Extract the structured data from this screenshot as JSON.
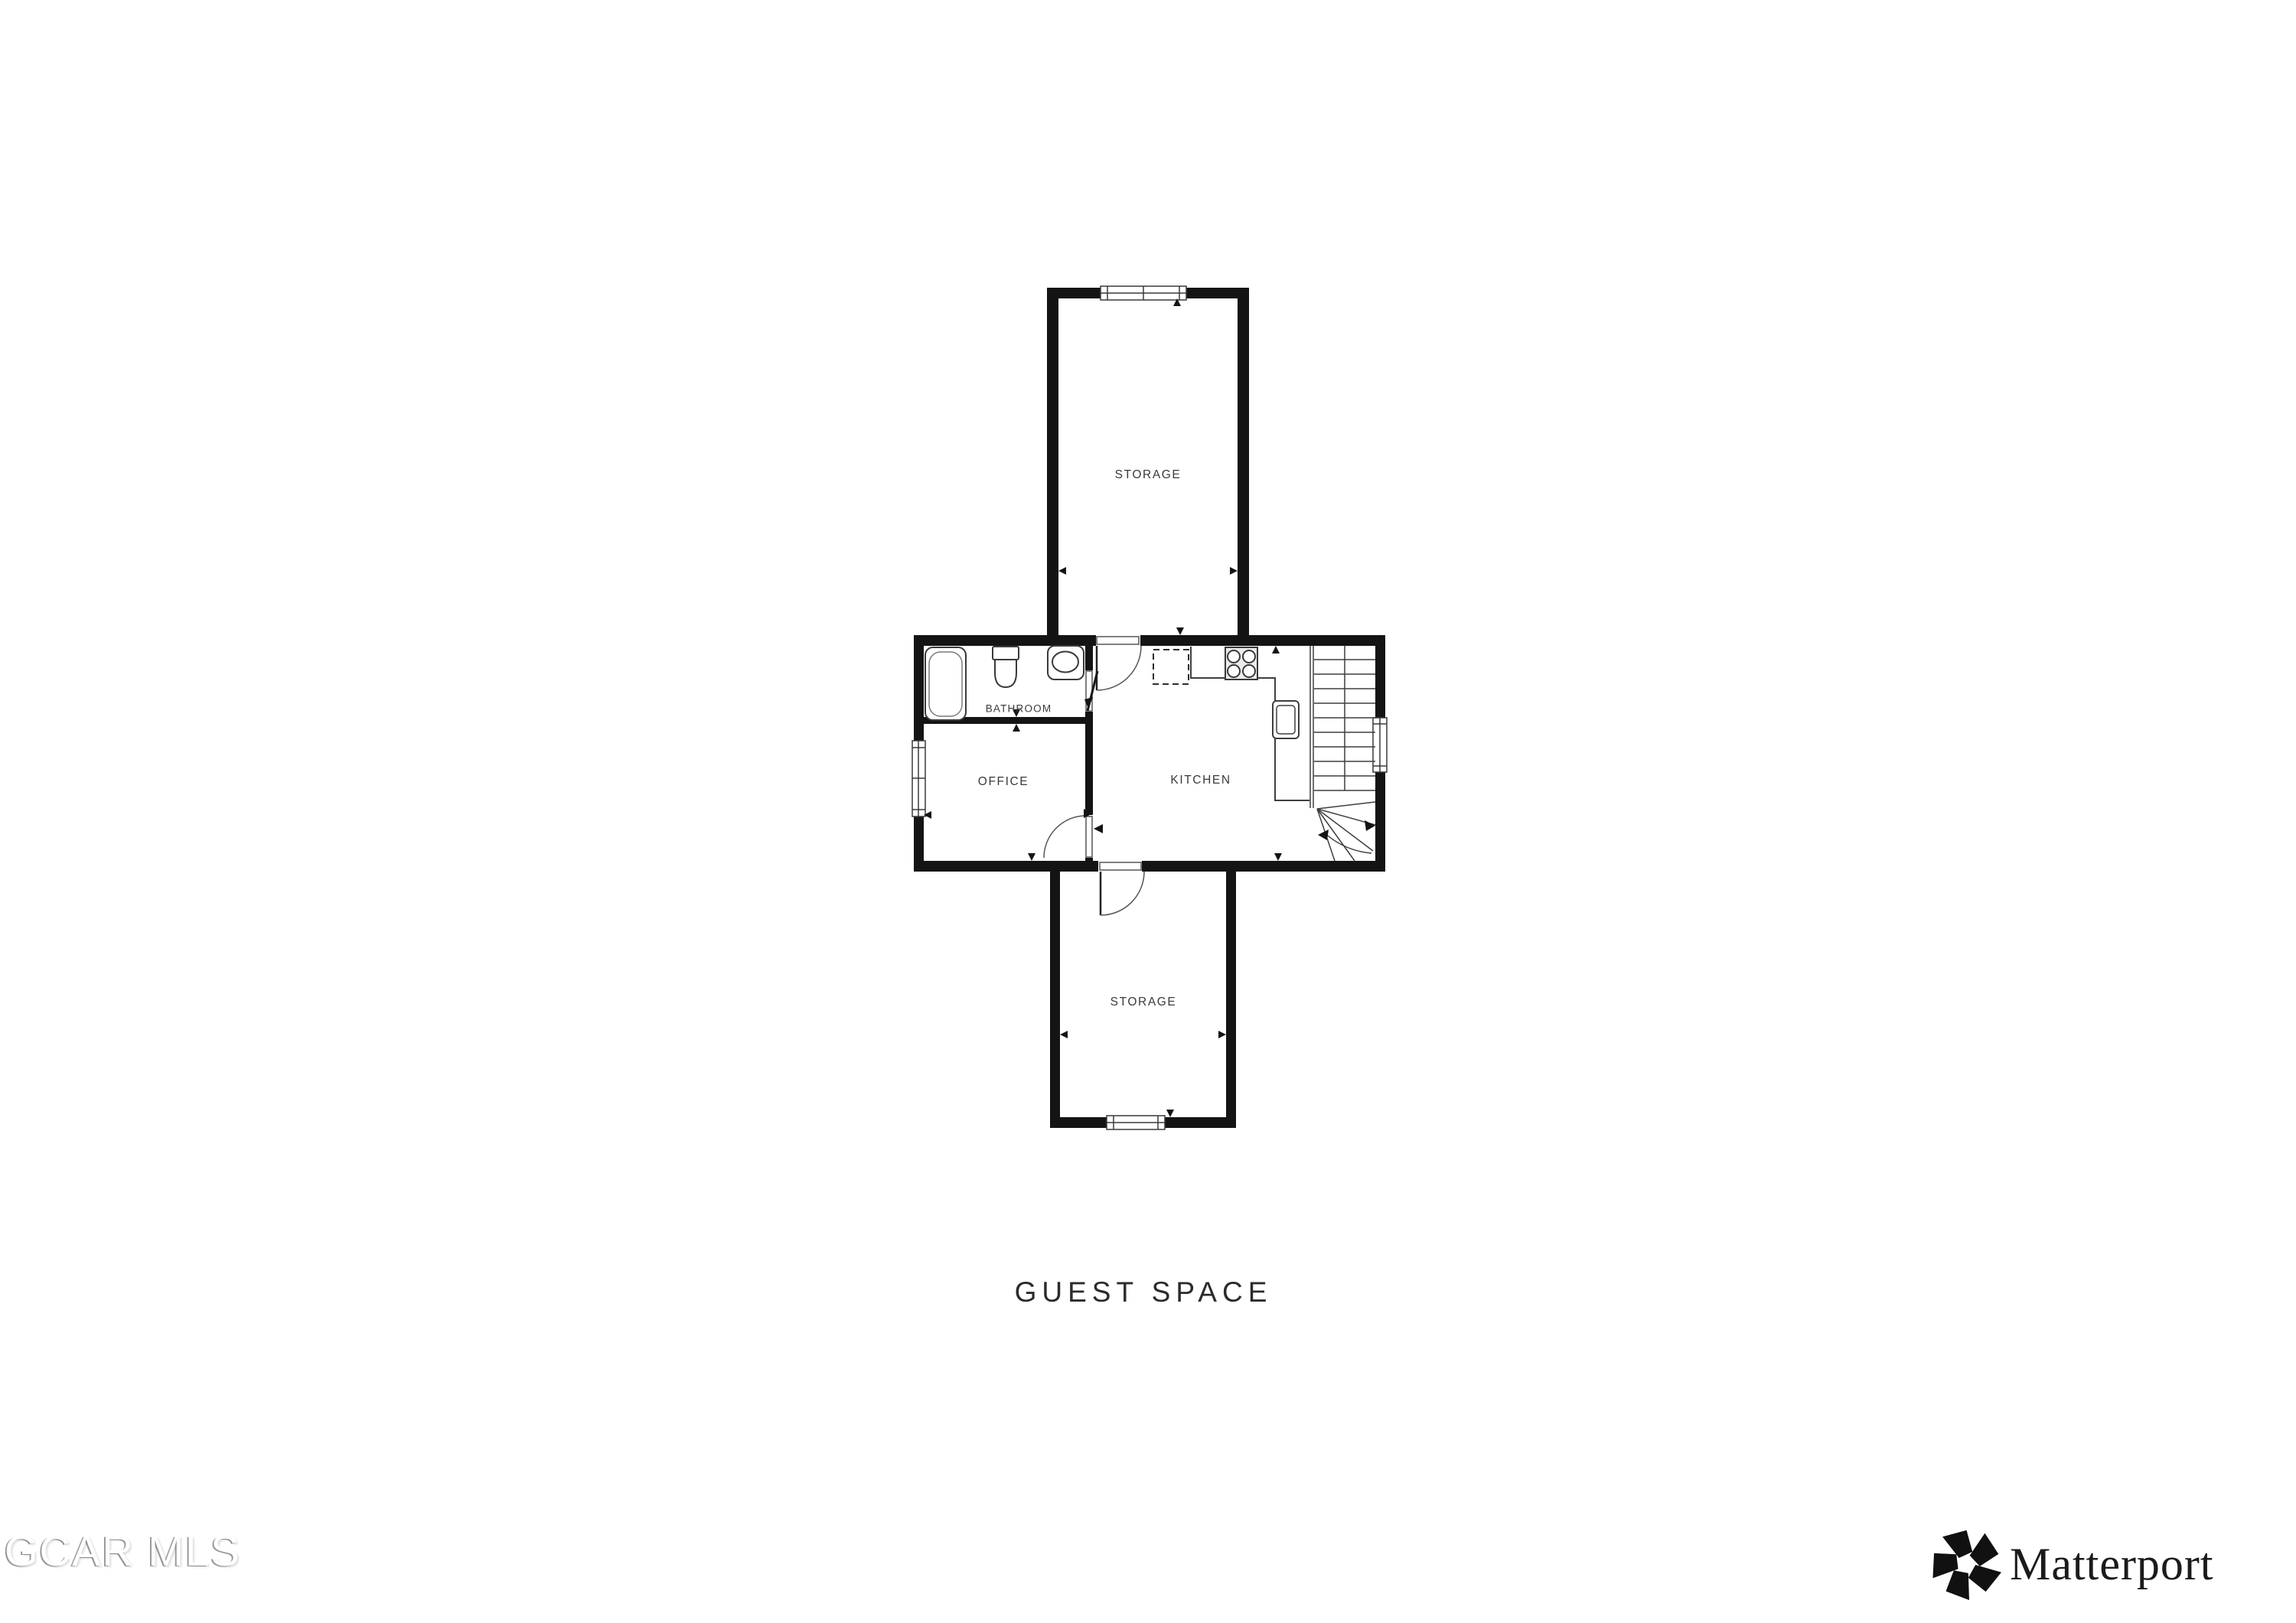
{
  "page": {
    "background": "#ffffff"
  },
  "floor_plan": {
    "title": "GUEST SPACE",
    "rooms": [
      {
        "id": "storage-top",
        "label": "STORAGE"
      },
      {
        "id": "bathroom",
        "label": "BATHROOM"
      },
      {
        "id": "office",
        "label": "OFFICE"
      },
      {
        "id": "kitchen",
        "label": "KITCHEN"
      },
      {
        "id": "storage-bottom",
        "label": "STORAGE"
      }
    ],
    "fixtures": [
      "bathtub",
      "toilet",
      "bathroom-sink",
      "stove",
      "kitchen-counter",
      "kitchen-sink",
      "appliance-dashed-outline",
      "staircase"
    ],
    "features": [
      "windows",
      "door-swings",
      "dimension-arrows"
    ],
    "colors": {
      "walls": "#141414",
      "labels": "#3a3a3a",
      "fixture_lines": "#3f3f3f",
      "title": "#2b2b2b"
    }
  },
  "watermark": {
    "text": "GCAR MLS"
  },
  "branding": {
    "logo_icon": "matterport-pinwheel-icon",
    "logo_text": "Matterport"
  }
}
